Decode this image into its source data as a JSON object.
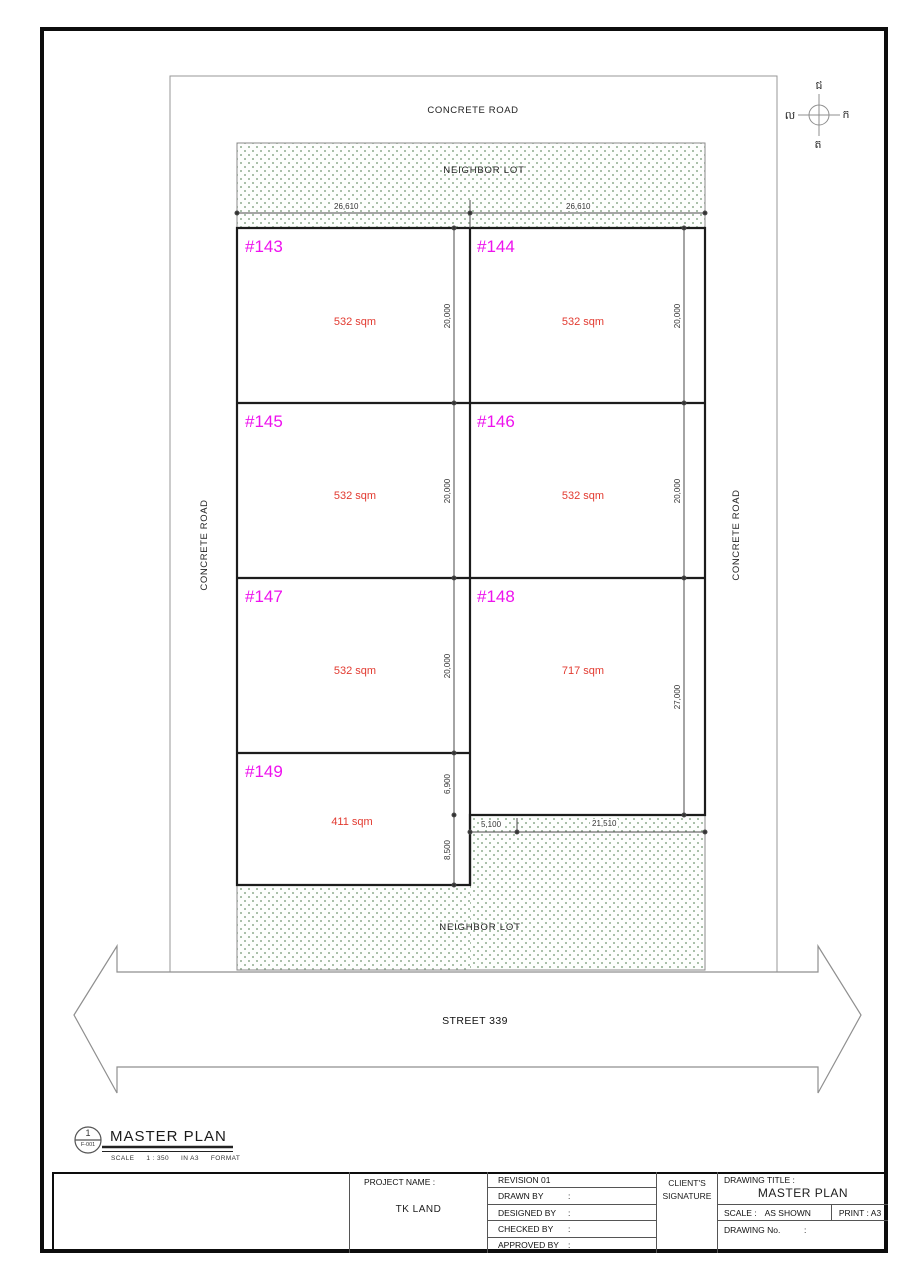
{
  "drawing": {
    "roads": {
      "top": "CONCRETE ROAD",
      "left": "CONCRETE ROAD",
      "right": "CONCRETE ROAD"
    },
    "street": "STREET 339",
    "neighbor_top": "NEIGHBOR LOT",
    "neighbor_bottom": "NEIGHBOR LOT",
    "compass": {
      "north": "ជ",
      "east": "ក",
      "south": "ត",
      "west": "ល"
    },
    "lots": [
      {
        "id": "#143",
        "area": "532 sqm"
      },
      {
        "id": "#144",
        "area": "532 sqm"
      },
      {
        "id": "#145",
        "area": "532 sqm"
      },
      {
        "id": "#146",
        "area": "532 sqm"
      },
      {
        "id": "#147",
        "area": "532 sqm"
      },
      {
        "id": "#148",
        "area": "717 sqm"
      },
      {
        "id": "#149",
        "area": "411 sqm"
      }
    ],
    "dims": {
      "top": [
        "26,610",
        "26,610"
      ],
      "bottom": [
        "5,100",
        "21,510"
      ],
      "col_left": [
        "20,000",
        "20,000",
        "20,000",
        "6,900",
        "8,500"
      ],
      "col_right": [
        "20,000",
        "20,000",
        "27,000"
      ]
    }
  },
  "callout": {
    "number": "1",
    "sheet": "F-001",
    "title": "MASTER PLAN",
    "scale_label": "SCALE",
    "scale": "1 : 350",
    "paper": "IN  A3",
    "format": "FORMAT"
  },
  "title_block": {
    "project_label": "PROJECT NAME :",
    "project_name": "TK LAND",
    "rows": [
      {
        "label": "REVISION 01",
        "colon": ""
      },
      {
        "label": "DRAWN BY",
        "colon": ":"
      },
      {
        "label": "DESIGNED BY",
        "colon": ":"
      },
      {
        "label": "CHECKED BY",
        "colon": ":"
      },
      {
        "label": "APPROVED BY",
        "colon": ":"
      }
    ],
    "client_line1": "CLIENT'S",
    "client_line2": "SIGNATURE",
    "drawing_title_label": "DRAWING TITLE :",
    "drawing_title": "MASTER PLAN",
    "scale_label": "SCALE :",
    "scale_value": "AS SHOWN",
    "print": "PRINT : A3",
    "drawing_no_label": "DRAWING No.",
    "drawing_no_colon": ":"
  },
  "colors": {
    "lot_id": "#ee12ee",
    "area_text": "#e23a30",
    "hatch_dot": "#9db79d",
    "line": "#1c1c1c"
  }
}
